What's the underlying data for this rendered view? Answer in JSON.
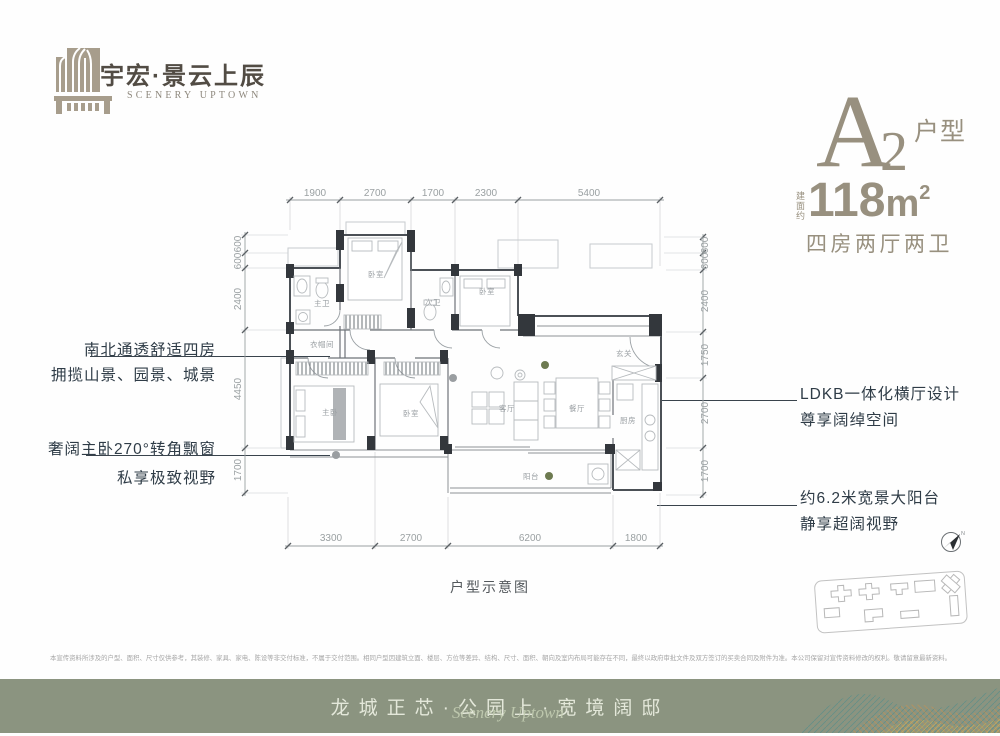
{
  "brand": {
    "logo_cn": "宇宏·景云上辰",
    "logo_en": "SCENERY UPTOWN"
  },
  "unit": {
    "letter": "A",
    "number": "2",
    "type_label": "户型",
    "area_prefix": "建面约",
    "area_value": "118",
    "area_unit": "m",
    "area_exp": "2",
    "layout": "四房两厅两卫"
  },
  "annotations": {
    "left_top_line1": "南北通透舒适四房",
    "left_top_line2": "拥揽山景、园景、城景",
    "left_bottom_line1": "奢阔主卧270°转角飘窗",
    "left_bottom_line2": "私享极致视野",
    "right_top_line1": "LDKB一体化横厅设计",
    "right_top_line2": "尊享阔绰空间",
    "right_bottom_line1": "约6.2米宽景大阳台",
    "right_bottom_line2": "静享超阔视野"
  },
  "plan": {
    "caption": "户型示意图",
    "compass_label": "N",
    "dims_top": [
      "1900",
      "2700",
      "1700",
      "2300",
      "5400"
    ],
    "dims_bottom": [
      "3300",
      "2700",
      "6200",
      "1800"
    ],
    "dims_left": [
      "600",
      "600",
      "2400",
      "4450",
      "1700"
    ],
    "dims_right": [
      "600",
      "600",
      "2400",
      "1750",
      "2700",
      "1700"
    ],
    "rooms": {
      "bedroom_top": "卧室",
      "master_bath": "主卫",
      "second_bath": "次卫",
      "bedroom_right": "卧室",
      "entry": "玄关",
      "closet": "衣帽间",
      "master_bedroom": "主卧",
      "bedroom_left": "卧室",
      "living": "客厅",
      "dining": "餐厅",
      "kitchen": "厨房",
      "balcony": "阳台"
    }
  },
  "disclaimer": "本宣传资料所涉及的户型、面积、尺寸仅供参考，其装修、家具、家电、陈设等非交付标准，不属于交付范围。相同户型因建筑立面、楼层、方位等差异、结构、尺寸、面积、朝向及室内布局可能存在不同，最终以政府审批文件及双方签订的买卖合同及附件为准。本公司保留对宣传资料修改的权利。敬请留意最新资料。",
  "footer": {
    "slogan": "龙城正芯·公园上·宽境阔邸",
    "script": "Scenery Uptown"
  },
  "colors": {
    "brand_taupe": "#a79d8c",
    "headline_taupe": "#98907f",
    "annotation_dark": "#2f3c47",
    "footer_bg": "#8b9480",
    "dim_gray": "#9aa0a2"
  }
}
